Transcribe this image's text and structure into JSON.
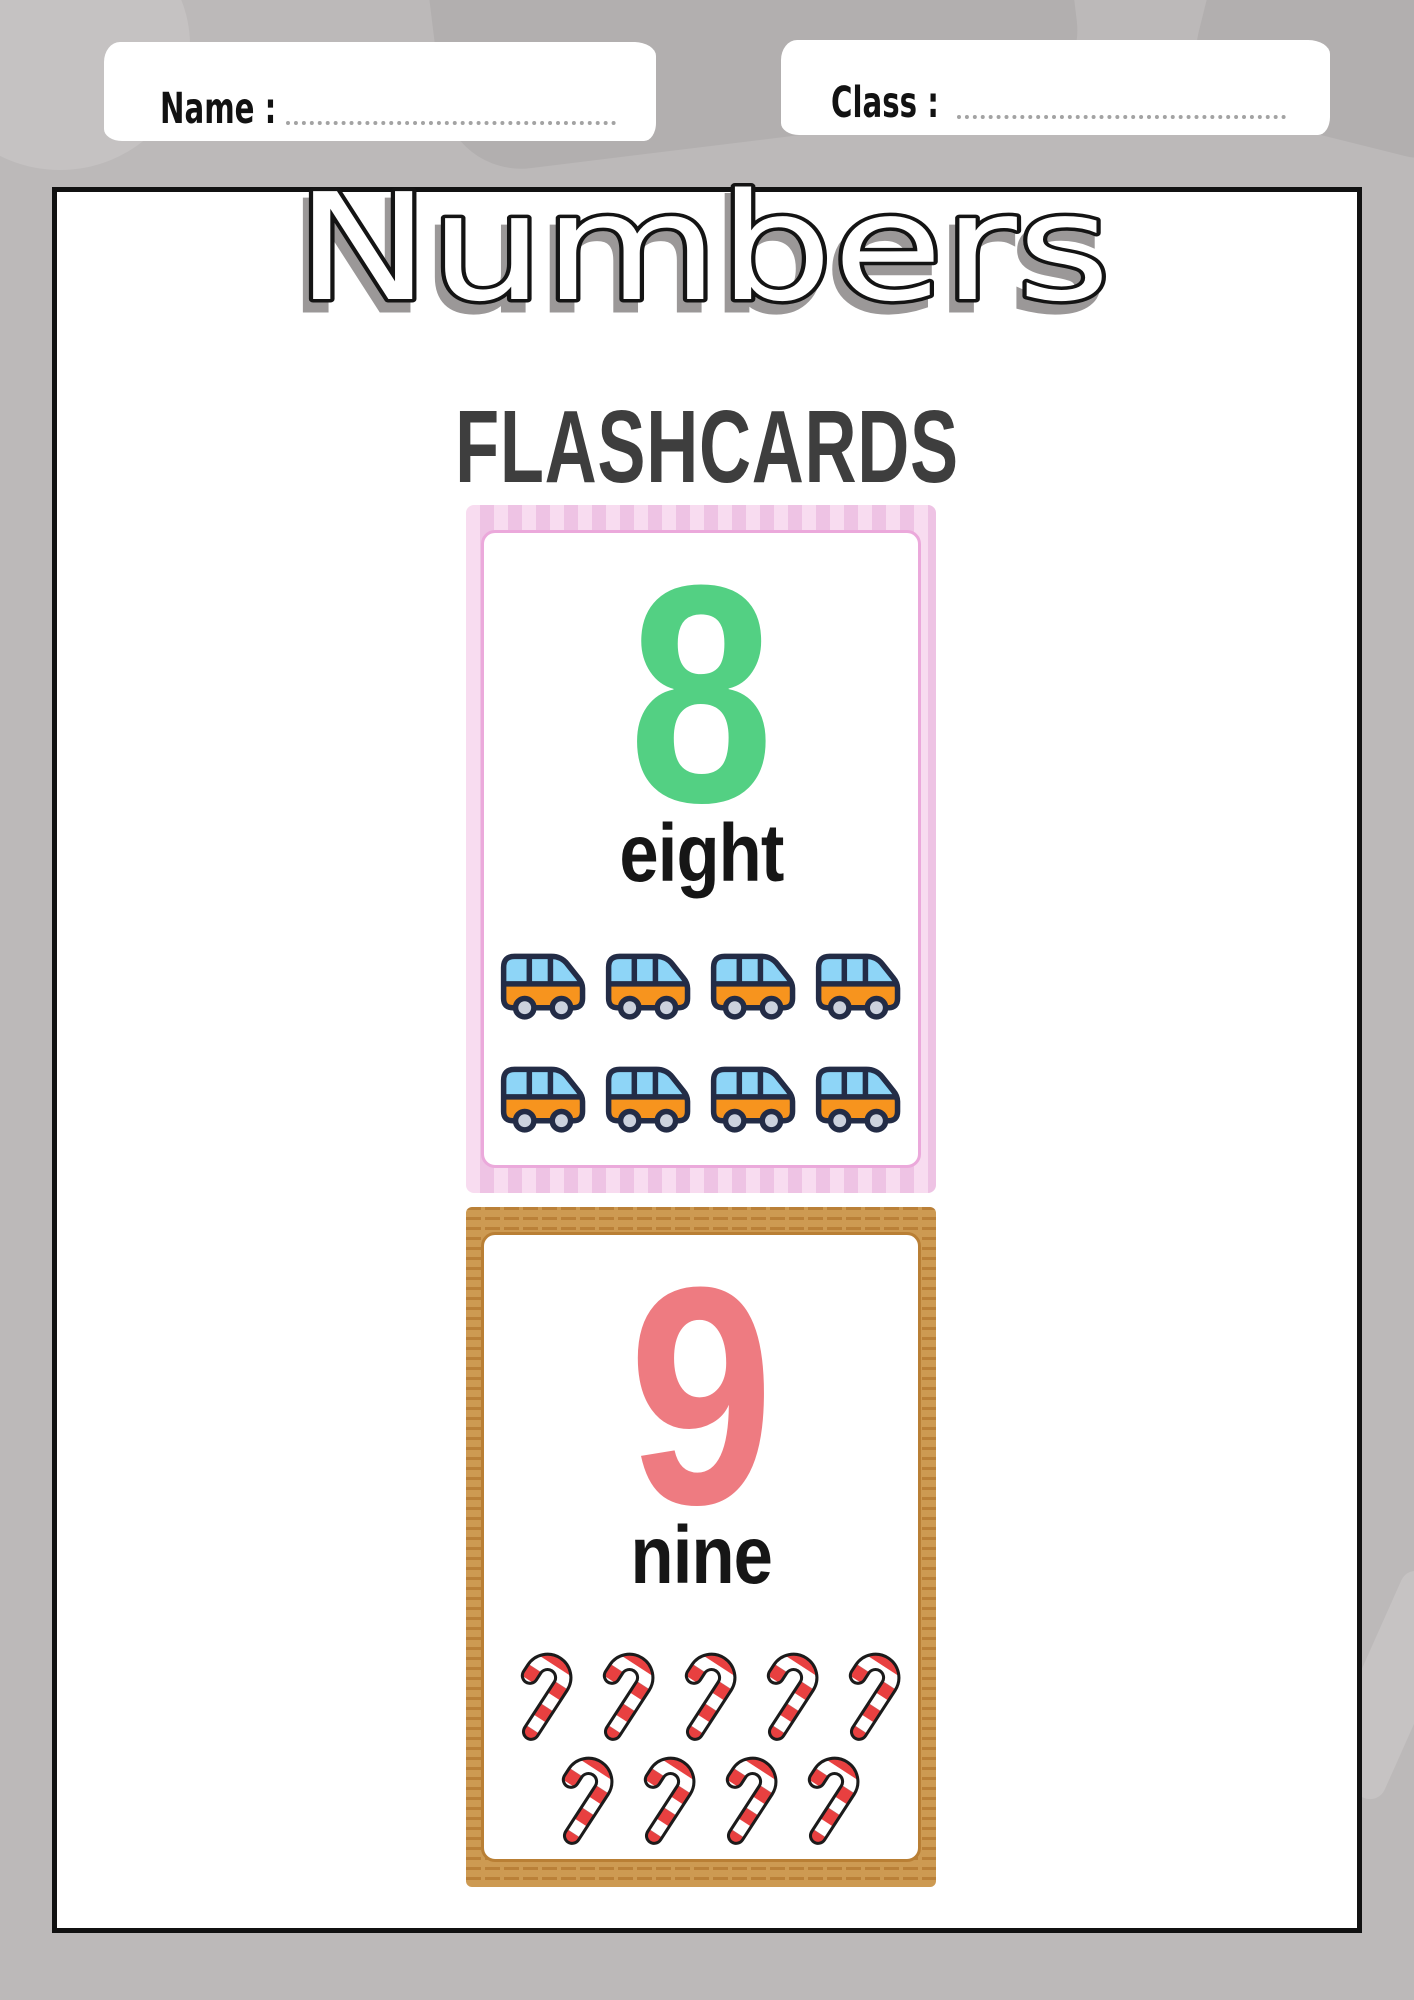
{
  "page": {
    "header": {
      "name_label": "Name :",
      "class_label": "Class :"
    },
    "title": "Numbers",
    "subtitle": "FLASHCARDS",
    "cards": [
      {
        "number": "8",
        "word": "eight",
        "icon": "bus-icon",
        "icon_count": 8,
        "number_color": "#53d083",
        "frame_style": "pink-stripes"
      },
      {
        "number": "9",
        "word": "nine",
        "icon": "candy-cane-icon",
        "icon_count": 9,
        "number_color": "#ee7b81",
        "frame_style": "brown-weave"
      }
    ],
    "colors": {
      "background_gray": "#bcb9b9",
      "page_border_black": "#111111",
      "subtitle_gray": "#3e3e3e",
      "title_shadow_gray": "#9b9898",
      "pink_stripe_light": "#f8dcf0",
      "pink_stripe_dark": "#eec3e4",
      "pink_inner_border": "#eba9db",
      "brown_frame": "#cd9a52",
      "brown_inner_border": "#b97f35",
      "bus_orange": "#f7941e",
      "bus_window_blue": "#8ed5f7",
      "bus_outline_navy": "#232c46",
      "bus_wheel_gray": "#ccd2de",
      "candy_cane_red": "#e84040",
      "dotted_line_gray": "#a3a3a3"
    }
  }
}
